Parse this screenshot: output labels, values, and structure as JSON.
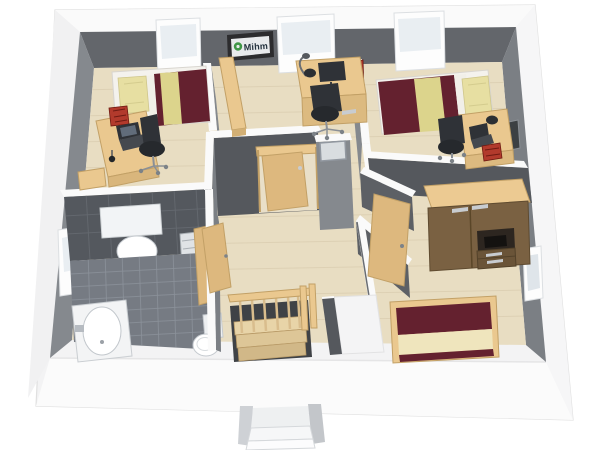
{
  "sign": {
    "text": "Mihm"
  },
  "colors": {
    "wall_top": "#fafafa",
    "wall_dark": "#63666b",
    "wall_mid": "#85898e",
    "wall_mid2": "#7b7f84",
    "wall_deep": "#55585d",
    "ext_band": "#f3f3f4",
    "ext_face": "#fbfbfb",
    "floor_wood": "#e8ddc2",
    "floor_line": "#d6c9ab",
    "tile_floor": "#767b83",
    "tile_line": "#8d939b",
    "tile_wall": "#54585e",
    "tile_wall_line": "#656a70",
    "wood_furn": "#eac88f",
    "wood_edge": "#c2a066",
    "wood_door": "#ddb87e",
    "wood_dark": "#7a6142",
    "wood_drawer": "#6a5438",
    "mattress": "#f4f2ed",
    "blanket": "#64212f",
    "cream": "#efe5bd",
    "pillow": "#e7dfa2",
    "throw": "#dcd48c",
    "black_furn": "#2f3237",
    "gray_metal": "#c8ccd0",
    "red_accent": "#b23a2c",
    "red_dark": "#6e1a12",
    "white_fix": "#ffffff",
    "fix_line": "#c5cacf",
    "glass": "#e9eef2",
    "frame_white": "#fdfdfd",
    "sign_frame": "#2c2c2e",
    "sign_bg": "#e8eaec",
    "sign_green": "#3f9646",
    "sign_text": "#22303c",
    "opening_dark": "#3f4246"
  },
  "scene": {
    "description": "3D cutaway dollhouse rendering of an upper floor plan",
    "rooms": [
      {
        "name": "bedroom-top-left",
        "items": [
          "single-bed",
          "desk",
          "laptop",
          "desk-chair",
          "red-storage-box",
          "sideboard"
        ]
      },
      {
        "name": "office-top-center",
        "items": [
          "desk",
          "monitor",
          "desk-lamp",
          "desk-chair",
          "red-wall-picture",
          "bookshelf",
          "wall-sign"
        ]
      },
      {
        "name": "bedroom-top-right",
        "items": [
          "single-bed",
          "desk",
          "laptop",
          "desk-chair",
          "red-storage-box"
        ]
      },
      {
        "name": "bathroom-bottom-left",
        "items": [
          "bathtub",
          "toilet",
          "washbasin",
          "mirror",
          "towel-radiator",
          "door"
        ]
      },
      {
        "name": "hallway-center",
        "items": [
          "staircase",
          "stair-railing",
          "open-door",
          "glass-panel"
        ]
      },
      {
        "name": "bedroom-bottom-right",
        "items": [
          "double-bed",
          "wardrobe",
          "open-door"
        ]
      }
    ],
    "windows": [
      "north-bedroom-left",
      "north-office",
      "north-bedroom-right",
      "west-bathroom",
      "east-bedroom-top-right",
      "east-bedroom-bottom-right"
    ]
  }
}
